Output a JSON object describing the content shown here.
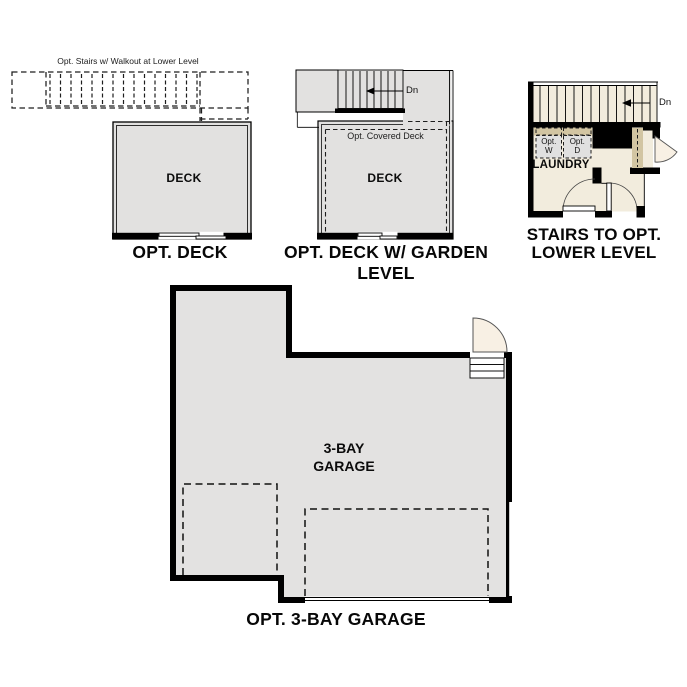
{
  "title": "Floor plan options sheet",
  "colors": {
    "wall": "#000000",
    "deck_fill": "#e2e1e0",
    "garage_fill": "#e3e2e1",
    "floor_cream": "#f2ecdd",
    "counter_tan": "#d2c5a2",
    "appliance_fill": "#e0e0e0",
    "door_fill": "#f8f0e4",
    "background": "#ffffff"
  },
  "plans": {
    "opt_deck": {
      "stairs_note": "Opt. Stairs w/ Walkout at Lower Level",
      "room_label": "DECK",
      "caption": "OPT. DECK"
    },
    "garden_deck": {
      "dn_label": "Dn",
      "covered_note": "Opt. Covered Deck",
      "room_label": "DECK",
      "caption": "OPT. DECK W/ GARDEN LEVEL"
    },
    "lower_level": {
      "dn_label": "Dn",
      "washer_label": "Opt.\nW",
      "dryer_label": "Opt.\nD",
      "room_label": "LAUNDRY",
      "caption": "STAIRS TO OPT.\nLOWER LEVEL"
    },
    "garage": {
      "room_label": "3-BAY\nGARAGE",
      "caption": "OPT. 3-BAY GARAGE"
    }
  }
}
